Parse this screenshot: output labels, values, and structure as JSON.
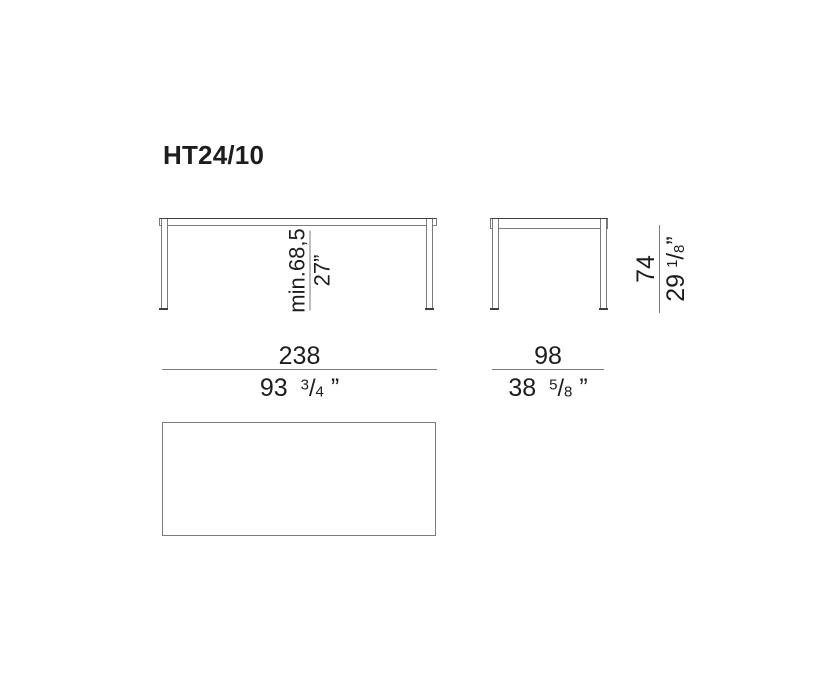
{
  "title": "HT24/10",
  "glyphs": {
    "fraction_slash": "/"
  },
  "colors": {
    "background": "#ffffff",
    "line": "#7b7b7b",
    "line_dark": "#3f3f3f",
    "text": "#1d1d1b"
  },
  "dimensions": {
    "front_clearance": {
      "metric": "min.68,5",
      "imperial": "27”"
    },
    "height": {
      "metric": "74",
      "imperial_whole": "29",
      "imperial_numerator": "1",
      "imperial_denominator": "8",
      "imperial_unit": "”"
    },
    "front_width": {
      "metric": "238",
      "imperial_whole": "93",
      "imperial_numerator": "3",
      "imperial_denominator": "4",
      "imperial_unit": "”"
    },
    "side_width": {
      "metric": "98",
      "imperial_whole": "38",
      "imperial_numerator": "5",
      "imperial_denominator": "8",
      "imperial_unit": "”"
    }
  }
}
